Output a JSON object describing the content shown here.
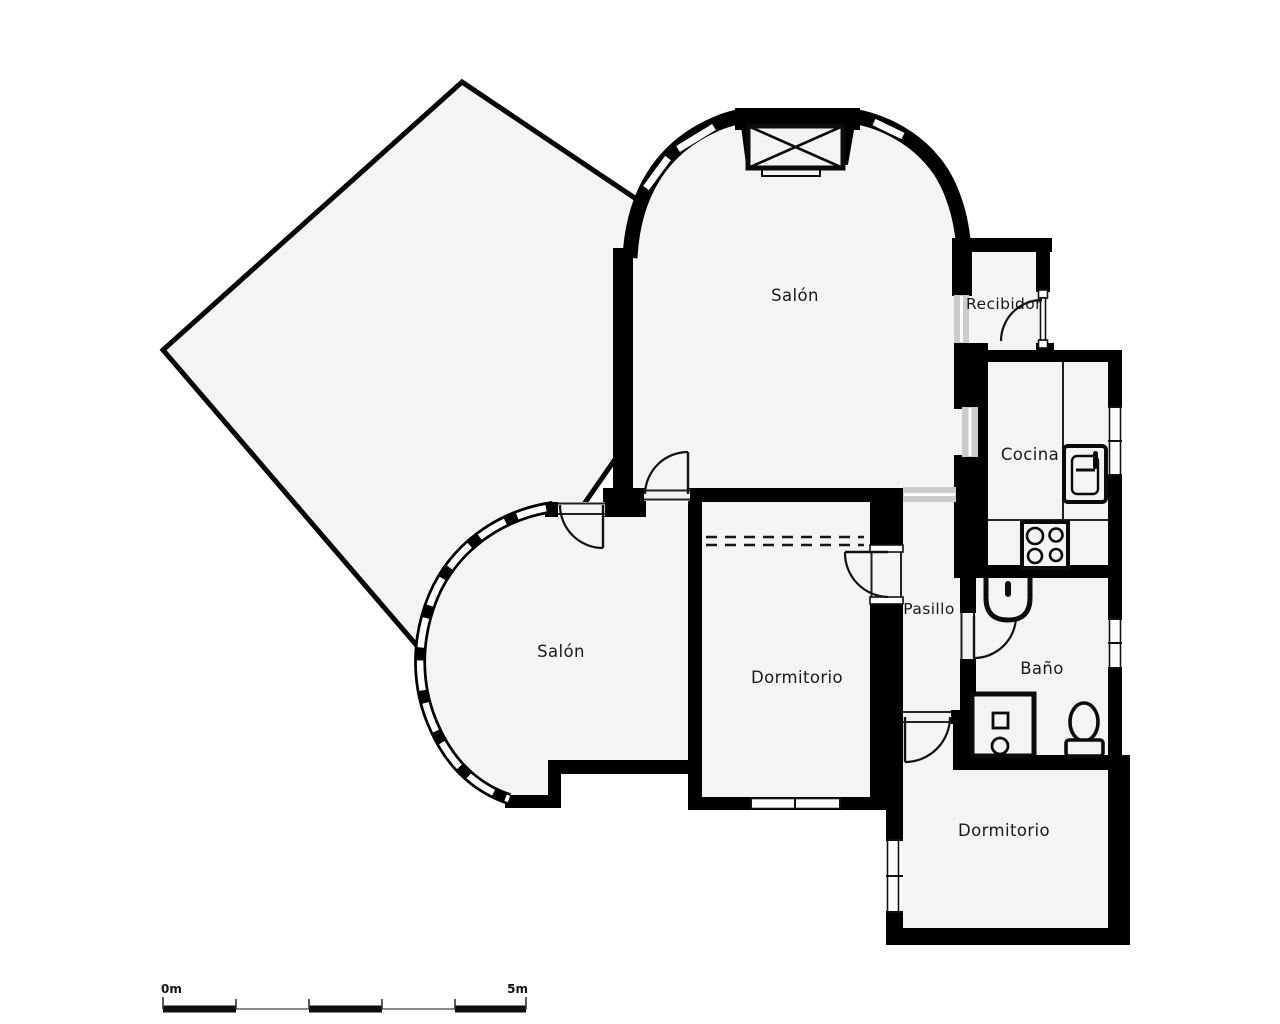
{
  "plan": {
    "title": "floor-plan",
    "rooms": [
      {
        "id": "salon-top",
        "label": "Salón"
      },
      {
        "id": "recibidor",
        "label": "Recibidor"
      },
      {
        "id": "cocina",
        "label": "Cocina"
      },
      {
        "id": "salon-bottom",
        "label": "Salón"
      },
      {
        "id": "pasillo",
        "label": "Pasillo"
      },
      {
        "id": "dormitorio-left",
        "label": "Dormitorio"
      },
      {
        "id": "bano",
        "label": "Baño"
      },
      {
        "id": "dormitorio-right",
        "label": "Dormitorio"
      }
    ],
    "fixtures": [
      "fireplace",
      "kitchen-counter",
      "kitchen-sink",
      "stove",
      "bath-sink",
      "shower",
      "toilet",
      "wardrobe",
      "bay-windows",
      "entry-door"
    ],
    "scale_bar": {
      "start_label": "0m",
      "end_label": "5m"
    },
    "colors": {
      "wall": "#000000",
      "floor": "#f4f4f4",
      "opening": "#cccccc",
      "ink": "#1a1a1a",
      "bg": "#ffffff"
    }
  }
}
